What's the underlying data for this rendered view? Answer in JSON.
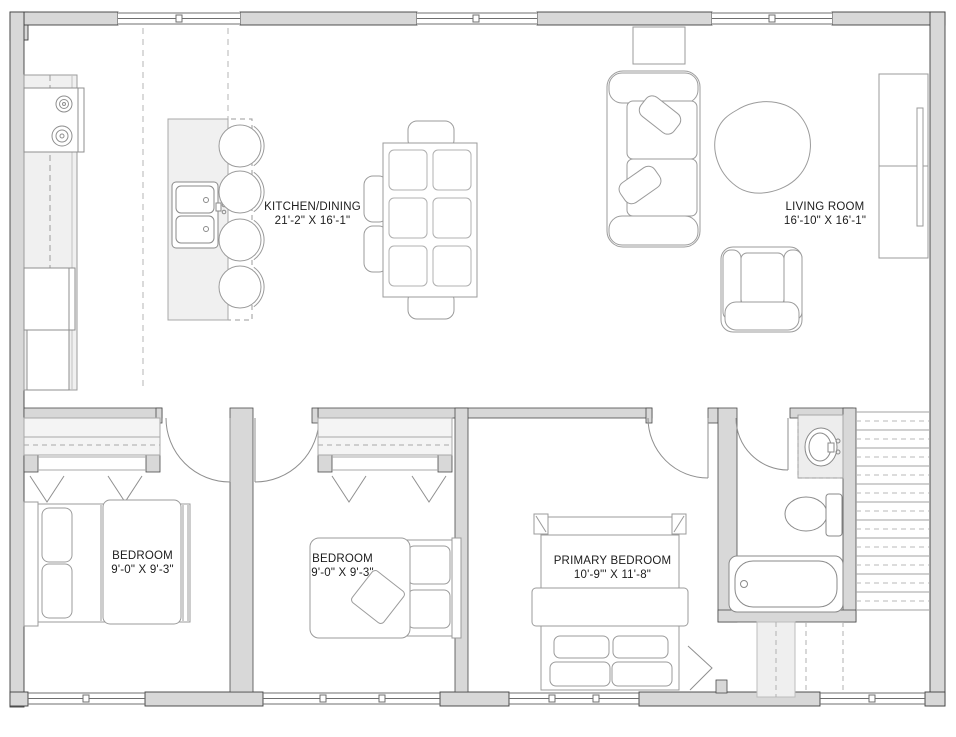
{
  "floorplan": {
    "rooms": [
      {
        "id": "kitchen-dining",
        "label": "KITCHEN/DINING",
        "dimensions": "21'-2\" X 16'-1\""
      },
      {
        "id": "living-room",
        "label": "LIVING ROOM",
        "dimensions": "16'-10\" X 16'-1\""
      },
      {
        "id": "bedroom-1",
        "label": "BEDROOM",
        "dimensions": "9'-0\" X 9'-3\""
      },
      {
        "id": "bedroom-2",
        "label": "BEDROOM",
        "dimensions": "9'-0\" X 9'-3\""
      },
      {
        "id": "primary-bedroom",
        "label": "PRIMARY BEDROOM",
        "dimensions": "10'-9\"' X 11'-8\""
      }
    ],
    "colors": {
      "background": "#ffffff",
      "wall_fill": "#d8d8d8",
      "wall_edge": "#3f3f3f",
      "furniture_line": "#9b9b9b",
      "counter_fill": "#f0f0f0",
      "text": "#1c1c1c"
    }
  }
}
